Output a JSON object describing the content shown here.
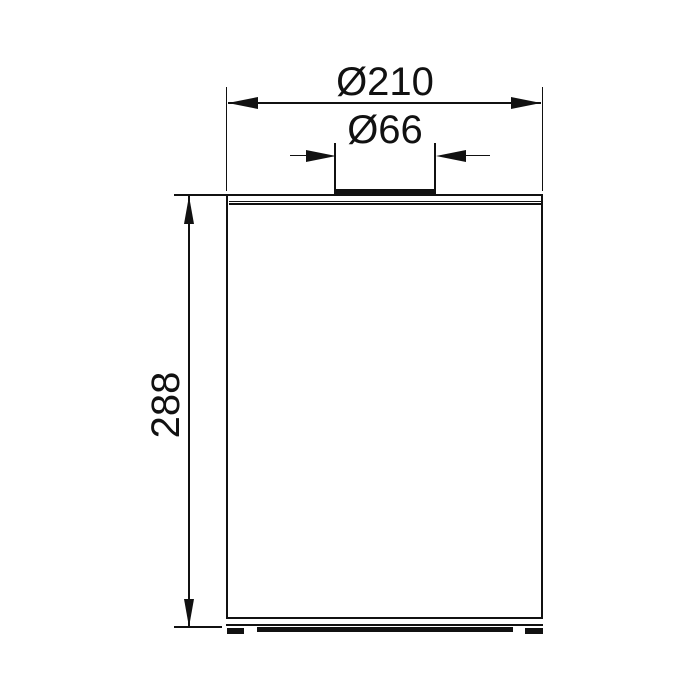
{
  "drawing": {
    "kind": "technical-dimension-drawing",
    "colors": {
      "line": "#111111",
      "background": "#ffffff"
    },
    "dimensions": {
      "outer_diameter": {
        "label": "Ø210",
        "value": 210
      },
      "opening_diameter": {
        "label": "Ø66",
        "value": 66
      },
      "height": {
        "label": "288",
        "value": 288
      }
    }
  }
}
